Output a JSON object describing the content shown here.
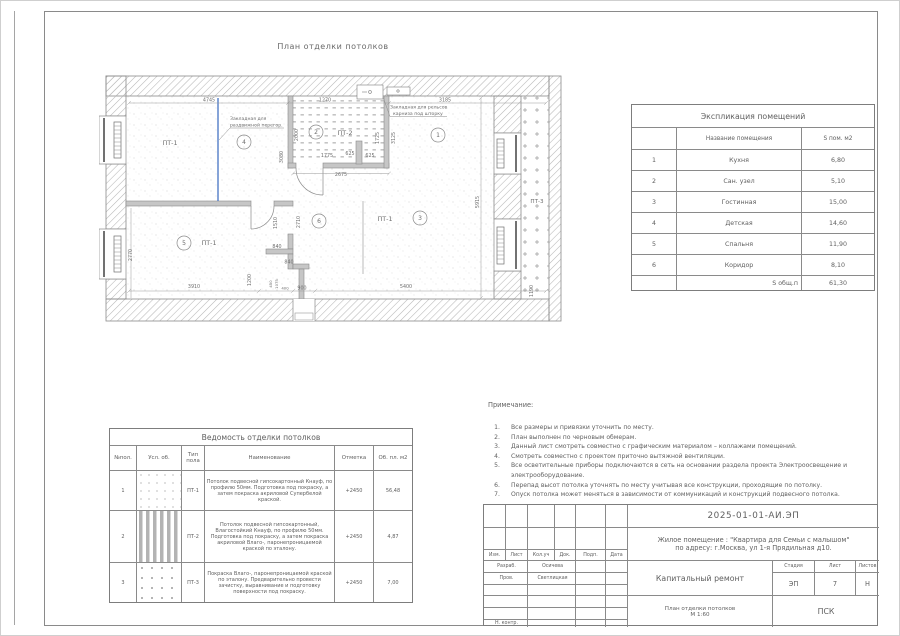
{
  "page": {
    "title": "План отделки потолков"
  },
  "plan": {
    "labels": {
      "pt1": "ПТ-1",
      "pt2": "ПТ-2",
      "pt3": "ПТ-3"
    },
    "rooms": {
      "r1": "1",
      "r2": "2",
      "r3": "3",
      "r4": "4",
      "r5": "5",
      "r6": "6"
    },
    "annotations": {
      "sliding1": "Закладная для",
      "sliding2": "раздвижной перегор.",
      "curtain1": "Закладная для рельсов",
      "curtain2": "карниза под шторку"
    },
    "dims": {
      "d4745": "4745",
      "d1270": "1270",
      "d3185": "3185",
      "d2000": "2000",
      "d1775": "1775",
      "d625a": "625",
      "d625b": "625",
      "d1725": "1725",
      "d3125": "3125",
      "d3080": "3080",
      "d2675": "2675",
      "d5915": "5915",
      "d2770": "2770",
      "d3910": "3910",
      "d5400": "5400",
      "d840a": "840",
      "d840b": "840",
      "d1200": "1200",
      "d450": "450",
      "d1075": "1075",
      "d400": "400",
      "d900": "900",
      "d1510": "1510",
      "d2710": "2710",
      "d1190": "1190"
    }
  },
  "explication": {
    "title": "Экспликация помещений",
    "headers": {
      "name": "Название помещения",
      "area": "S пом. м2"
    },
    "rows": [
      {
        "num": "1",
        "name": "Кухня",
        "area": "6,80"
      },
      {
        "num": "2",
        "name": "Сан. узел",
        "area": "5,10"
      },
      {
        "num": "3",
        "name": "Гостинная",
        "area": "15,00"
      },
      {
        "num": "4",
        "name": "Детская",
        "area": "14,60"
      },
      {
        "num": "5",
        "name": "Спальня",
        "area": "11,90"
      },
      {
        "num": "6",
        "name": "Коридор",
        "area": "8,10"
      }
    ],
    "total": {
      "label": "S общ.п",
      "value": "61,30"
    }
  },
  "vedomost": {
    "title": "Ведомость отделки потолков",
    "headers": {
      "num": "№пол.",
      "symbol": "Усл. об.",
      "type": "Тип пола",
      "name": "Наименование",
      "mark": "Отметка",
      "area": "Об. пл. м2"
    },
    "rows": [
      {
        "num": "1",
        "type": "ПТ-1",
        "mark": "+2450",
        "area": "56,48",
        "name": "Потолок подвесной гипсокартонный Кнауф, по профилю 50мм. Подготовка под покраску, а затем покраска акриловой Супербелой краской."
      },
      {
        "num": "2",
        "type": "ПТ-2",
        "mark": "+2450",
        "area": "4,87",
        "name": "Потолок подвесной гипсокартонный, Влагостойкий Кнауф, по профилю 50мм. Подготовка под покраску, а затем покраска акриловой Влаго-, паронепроницаемой краской по эталону."
      },
      {
        "num": "3",
        "type": "ПТ-3",
        "mark": "+2450",
        "area": "7,00",
        "name": "Покраска Влаго-, паронепроницаемой краской по эталону. Предварительно провести зачистку, выравнивание и подготовку поверхности под покраску."
      }
    ]
  },
  "notes": {
    "title": "Примечание:",
    "items": [
      {
        "num": "1.",
        "text": "Все размеры и привязки уточнить по месту."
      },
      {
        "num": "2.",
        "text": "План выполнен по черновым обмерам."
      },
      {
        "num": "3.",
        "text": "Данный лист смотреть совместно с графическим материалом – коллажами помещений."
      },
      {
        "num": "4.",
        "text": "Смотреть совместно с проектом приточно вытяжной вентиляции."
      },
      {
        "num": "5.",
        "text": "Все осветительные приборы подключаются в сеть на основании раздела проекта Электроосвещение и электрооборудование."
      },
      {
        "num": "6.",
        "text": "Перепад высот потолка уточнять по месту учитывая все конструкции, проходящие по потолку."
      },
      {
        "num": "7.",
        "text": "Опуск потолка может меняться в зависимости от коммуникаций и конструкций подвесного потолка."
      }
    ]
  },
  "titleblock": {
    "doc_number": "2025-01-01-АИ.ЭП",
    "project_line1": "Жилое помещение : \"Квартира для Семьи с малышом\"",
    "project_line2": "по адресу: г.Москва, ул 1-я Прядильная д10.",
    "work_type": "Капитальный ремонт",
    "sheet_name1": "План отделки потолков",
    "sheet_name2": "М 1:60",
    "org": "ПСК",
    "stage_label": "Стадия",
    "sheet_label": "Лист",
    "sheets_label": "Листов",
    "stage": "ЭП",
    "sheet": "7",
    "sheets": "Н",
    "cols": {
      "izm": "Изм.",
      "list": "Лист",
      "koluch": "Кол.уч",
      "dok": "Док.",
      "podp": "Подп.",
      "data": "Дата"
    },
    "roles": {
      "razrab": "Разраб.",
      "razrab_name": "Осичева",
      "prov": "Пров.",
      "prov_name": "Светлицкая",
      "nkontr": "Н. контр."
    }
  },
  "colors": {
    "accent_blue": "#4472c4"
  }
}
